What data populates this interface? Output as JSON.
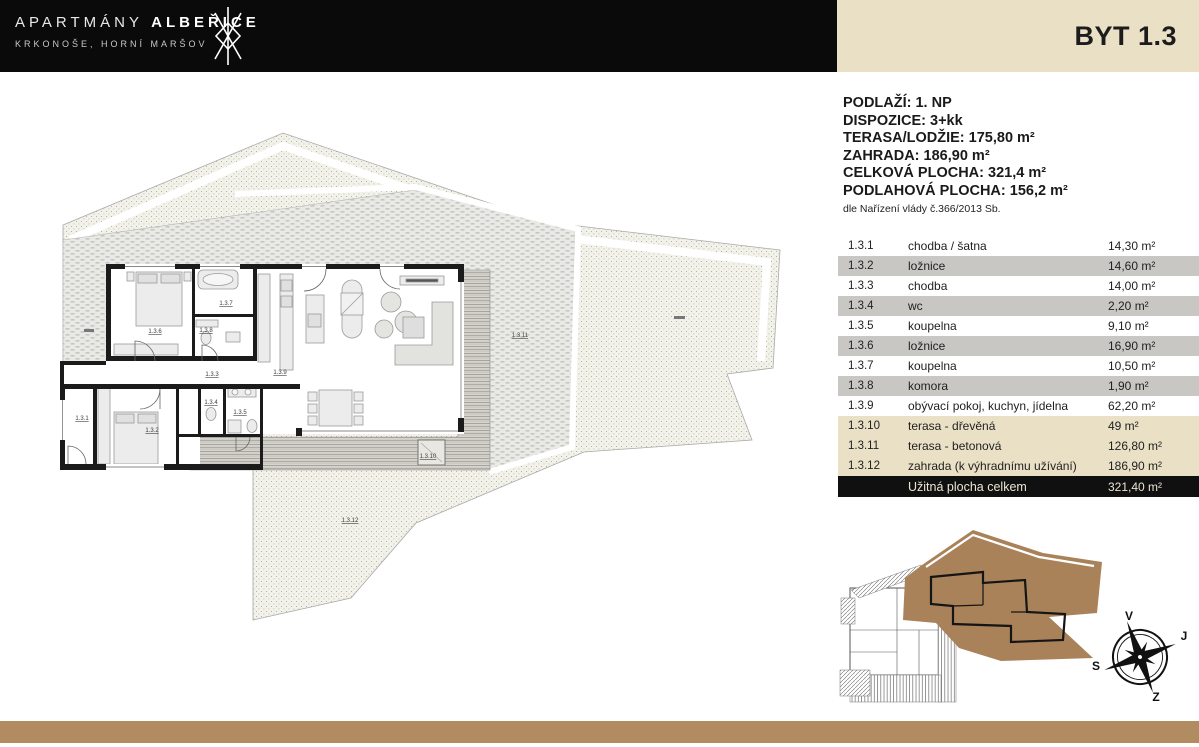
{
  "header": {
    "brand_title_light": "APARTMÁNY",
    "brand_title_bold": "ALBEŘICE",
    "brand_subtitle": "KRKONOŠE, HORNÍ MARŠOV",
    "unit_label": "BYT 1.3"
  },
  "details": {
    "lines": [
      "PODLAŽÍ: 1. NP",
      "DISPOZICE: 3+kk",
      "TERASA/LODŽIE: 175,80 m²",
      "ZAHRADA: 186,90 m²",
      "CELKOVÁ PLOCHA: 321,4 m²",
      "PODLAHOVÁ PLOCHA: 156,2 m²"
    ],
    "note": "dle Nařízení vlády č.366/2013 Sb."
  },
  "room_table": {
    "rows": [
      {
        "no": "1.3.1",
        "name": "chodba / šatna",
        "area": "14,30 m²",
        "style": "white"
      },
      {
        "no": "1.3.2",
        "name": "ložnice",
        "area": "14,60 m²",
        "style": "gray"
      },
      {
        "no": "1.3.3",
        "name": "chodba",
        "area": "14,00 m²",
        "style": "white"
      },
      {
        "no": "1.3.4",
        "name": "wc",
        "area": "2,20 m²",
        "style": "gray"
      },
      {
        "no": "1.3.5",
        "name": "koupelna",
        "area": "9,10 m²",
        "style": "white"
      },
      {
        "no": "1.3.6",
        "name": "ložnice",
        "area": "16,90 m²",
        "style": "gray"
      },
      {
        "no": "1.3.7",
        "name": "koupelna",
        "area": "10,50 m²",
        "style": "white"
      },
      {
        "no": "1.3.8",
        "name": "komora",
        "area": "1,90 m²",
        "style": "gray"
      },
      {
        "no": "1.3.9",
        "name": "obývací pokoj, kuchyn, jídelna",
        "area": "62,20 m²",
        "style": "white"
      },
      {
        "no": "1.3.10",
        "name": "terasa - dřevěná",
        "area": "49 m²",
        "style": "beige"
      },
      {
        "no": "1.3.11",
        "name": "terasa - betonová",
        "area": "126,80 m²",
        "style": "beige"
      },
      {
        "no": "1.3.12",
        "name": "zahrada (k výhradnímu užívání)",
        "area": "186,90 m²",
        "style": "beige"
      }
    ],
    "total": {
      "label": "Užitná plocha celkem",
      "area": "321,40 m²"
    }
  },
  "plan_labels": {
    "l1": "1.3.1",
    "l2": "1.3.2",
    "l3": "1.3.3",
    "l4": "1.3.4",
    "l5": "1.3.5",
    "l6": "1.3.6",
    "l7": "1.3.7",
    "l8": "1.3.8",
    "l9": "1.3.9",
    "l10": "1.3.10",
    "l11": "1.3.11",
    "l12": "1.3.12"
  },
  "compass": {
    "top": "V",
    "right": "J",
    "left": "S",
    "bottom": "Z"
  },
  "colors": {
    "header_black": "#0a0a0a",
    "panel_beige": "#e9e0c5",
    "row_gray": "#c8c7c4",
    "total_black": "#101010",
    "bottom_bar_brown": "#b18c60",
    "site_highlight_brown": "#a9825a"
  }
}
